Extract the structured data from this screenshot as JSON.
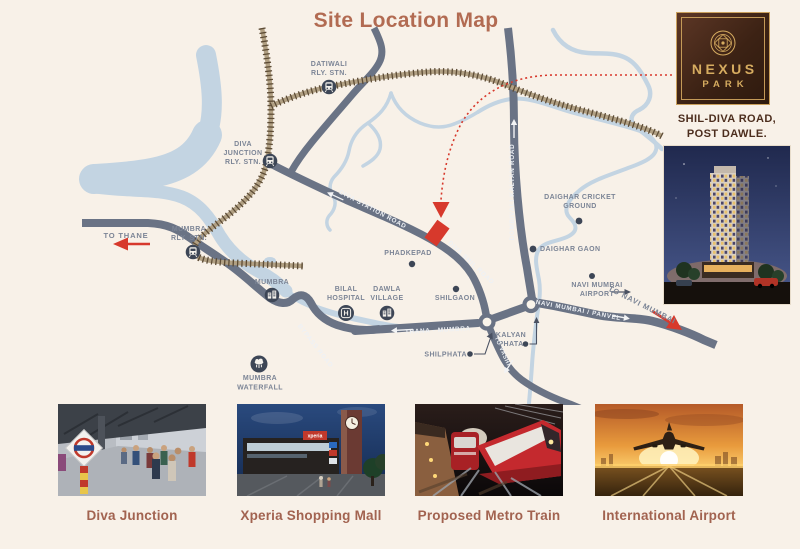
{
  "title": "Site Location Map",
  "brand": {
    "name_line1": "NEXUS",
    "name_line2": "PARK",
    "address_line1": "SHIL-DIVA ROAD,",
    "address_line2": "POST DAWLE."
  },
  "map": {
    "stations": [
      {
        "line1": "DATIWALI",
        "line2": "RLY. STN."
      },
      {
        "line1": "DIVA",
        "line2": "JUNCTION",
        "line3": "RLY. STN."
      },
      {
        "line1": "MUMBRA",
        "line2": "RLY. STN."
      }
    ],
    "places": {
      "mumbra": "MUMBRA",
      "bilal1": "BILAL",
      "bilal2": "HOSPITAL",
      "dawla1": "DAWLA",
      "dawla2": "VILLAGE",
      "phadkepad": "PHADKEPAD",
      "shilgaon": "SHILGAON",
      "cricket1": "DAIGHAR CRICKET",
      "cricket2": "GROUND",
      "daighar_gaon": "DAIGHAR GAON",
      "airport1": "NAVI MUMBAI",
      "airport2": "AIRPORT",
      "kalyan1": "KALYAN",
      "kalyan2": "PHATA",
      "shilphata": "SHILPHATA",
      "waterfall1": "MUMBRA",
      "waterfall2": "WATERFALL"
    },
    "roads": {
      "diva_station": "DIVA STATION ROAD",
      "diva_shil": "DIVA SHIL ROAD",
      "dombivali": "DOMBIVALI KALYAN ROAD",
      "thana_mumbra": "THANA - MUMBRA",
      "navi_mumbai_panvel": "NAVI MUMBAI / PANVEL",
      "bypass": "BYPASS ROAD",
      "vashi": "TO VASHI"
    },
    "directions": {
      "to_thane": "TO THANE",
      "to_navi_mumbai": "TO NAVI MUMBAI"
    },
    "icons": {
      "hospital_glyph": "H"
    }
  },
  "gallery": [
    {
      "caption": "Diva Junction"
    },
    {
      "caption": "Xperia Shopping Mall",
      "sign": "xperia"
    },
    {
      "caption": "Proposed Metro Train"
    },
    {
      "caption": "International Airport"
    }
  ],
  "colors": {
    "background": "#f8f1e8",
    "accent_red": "#d7392c",
    "road": "#6a7385",
    "river": "#c3d4e2",
    "railway": "#6b5940",
    "map_label": "#7c8596",
    "title": "#b26b52",
    "caption": "#a26350",
    "gold": "#c9a05a"
  }
}
